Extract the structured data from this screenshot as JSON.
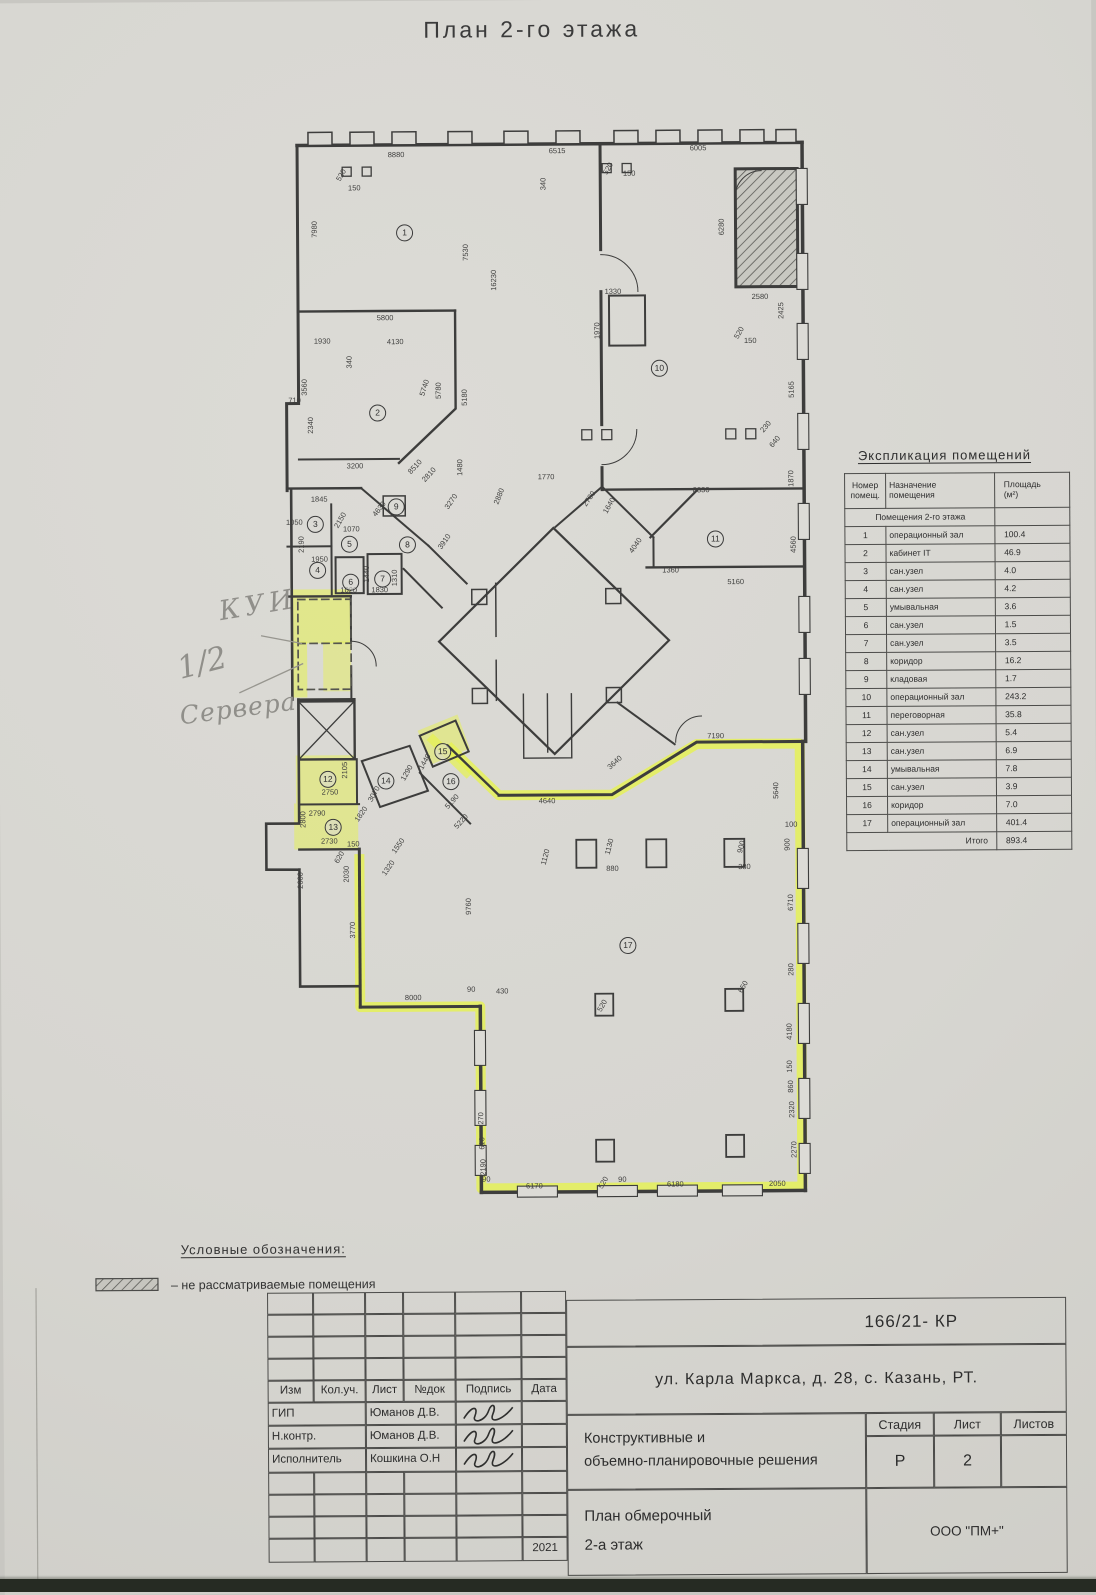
{
  "page": {
    "title": "План 2-го этажа"
  },
  "handwriting": {
    "note_kui": "КУИ",
    "note_half": "1/2",
    "note_servers": "Сервера"
  },
  "legend": {
    "heading": "Условные обозначения:",
    "item": "–  не рассматриваемые помещения"
  },
  "explication": {
    "title": "Экспликация помещений",
    "col1_line1": "Номер",
    "col1_line2": "помещ.",
    "col2_line1": "Назначение",
    "col2_line2": "помещения",
    "col3_line1": "Площадь",
    "col3_line2": "(м²)",
    "group": "Помещения 2-го этажа",
    "rows": [
      {
        "n": "1",
        "name": "операционный зал",
        "area": "100.4"
      },
      {
        "n": "2",
        "name": "кабинет IT",
        "area": "46.9"
      },
      {
        "n": "3",
        "name": "сан.узел",
        "area": "4.0"
      },
      {
        "n": "4",
        "name": "сан.узел",
        "area": "4.2"
      },
      {
        "n": "5",
        "name": "умывальная",
        "area": "3.6"
      },
      {
        "n": "6",
        "name": "сан.узел",
        "area": "1.5"
      },
      {
        "n": "7",
        "name": "сан.узел",
        "area": "3.5"
      },
      {
        "n": "8",
        "name": "коридор",
        "area": "16.2"
      },
      {
        "n": "9",
        "name": "кладовая",
        "area": "1.7"
      },
      {
        "n": "10",
        "name": "операционный зал",
        "area": "243.2"
      },
      {
        "n": "11",
        "name": "переговорная",
        "area": "35.8"
      },
      {
        "n": "12",
        "name": "сан.узел",
        "area": "5.4"
      },
      {
        "n": "13",
        "name": "сан.узел",
        "area": "6.9"
      },
      {
        "n": "14",
        "name": "умывальная",
        "area": "7.8"
      },
      {
        "n": "15",
        "name": "сан.узел",
        "area": "3.9"
      },
      {
        "n": "16",
        "name": "коридор",
        "area": "7.0"
      },
      {
        "n": "17",
        "name": "операционный зал",
        "area": "401.4"
      }
    ],
    "total_label": "Итого",
    "total": "893.4"
  },
  "plan": {
    "rooms": [
      {
        "n": "1",
        "x": 408,
        "y": 232
      },
      {
        "n": "2",
        "x": 380,
        "y": 412
      },
      {
        "n": "3",
        "x": 317,
        "y": 523
      },
      {
        "n": "4",
        "x": 319,
        "y": 569
      },
      {
        "n": "5",
        "x": 351,
        "y": 543
      },
      {
        "n": "6",
        "x": 352,
        "y": 581
      },
      {
        "n": "7",
        "x": 384,
        "y": 578
      },
      {
        "n": "8",
        "x": 409,
        "y": 544
      },
      {
        "n": "9",
        "x": 398,
        "y": 506
      },
      {
        "n": "10",
        "x": 662,
        "y": 369
      },
      {
        "n": "11",
        "x": 717,
        "y": 540
      },
      {
        "n": "12",
        "x": 328,
        "y": 778
      },
      {
        "n": "13",
        "x": 333,
        "y": 826
      },
      {
        "n": "14",
        "x": 386,
        "y": 780
      },
      {
        "n": "15",
        "x": 443,
        "y": 751
      },
      {
        "n": "16",
        "x": 451,
        "y": 781
      },
      {
        "n": "17",
        "x": 627,
        "y": 946
      }
    ],
    "dimensions": [
      {
        "t": "8880",
        "x": 400,
        "y": 154,
        "r": 0
      },
      {
        "t": "6515",
        "x": 561,
        "y": 151,
        "r": 0
      },
      {
        "t": "6005",
        "x": 702,
        "y": 149,
        "r": 0
      },
      {
        "t": "520",
        "x": 345,
        "y": 174,
        "r": -60
      },
      {
        "t": "150",
        "x": 358,
        "y": 187,
        "r": 0
      },
      {
        "t": "340",
        "x": 547,
        "y": 184,
        "r": -90
      },
      {
        "t": "520",
        "x": 612,
        "y": 169,
        "r": -60
      },
      {
        "t": "150",
        "x": 633,
        "y": 174,
        "r": 0
      },
      {
        "t": "7980",
        "x": 318,
        "y": 228,
        "r": -90
      },
      {
        "t": "7530",
        "x": 469,
        "y": 252,
        "r": -90
      },
      {
        "t": "16230",
        "x": 497,
        "y": 280,
        "r": -90
      },
      {
        "t": "2340",
        "x": 313,
        "y": 424,
        "r": -90
      },
      {
        "t": "3560",
        "x": 307,
        "y": 386,
        "r": -90
      },
      {
        "t": "710",
        "x": 297,
        "y": 399,
        "r": 0
      },
      {
        "t": "5800",
        "x": 388,
        "y": 317,
        "r": 0
      },
      {
        "t": "1930",
        "x": 325,
        "y": 340,
        "r": 0
      },
      {
        "t": "4130",
        "x": 398,
        "y": 341,
        "r": 0
      },
      {
        "t": "340",
        "x": 352,
        "y": 361,
        "r": -90
      },
      {
        "t": "5740",
        "x": 427,
        "y": 387,
        "r": -72
      },
      {
        "t": "5780",
        "x": 441,
        "y": 390,
        "r": -90
      },
      {
        "t": "5180",
        "x": 467,
        "y": 397,
        "r": -90
      },
      {
        "t": "1480",
        "x": 462,
        "y": 467,
        "r": -90
      },
      {
        "t": "8510",
        "x": 417,
        "y": 466,
        "r": -47
      },
      {
        "t": "2810",
        "x": 431,
        "y": 474,
        "r": -47
      },
      {
        "t": "3200",
        "x": 357,
        "y": 465,
        "r": 0
      },
      {
        "t": "1845",
        "x": 321,
        "y": 498,
        "r": 0
      },
      {
        "t": "1050",
        "x": 296,
        "y": 521,
        "r": 0
      },
      {
        "t": "2190",
        "x": 303,
        "y": 543,
        "r": -90
      },
      {
        "t": "1950",
        "x": 321,
        "y": 558,
        "r": 0
      },
      {
        "t": "2150",
        "x": 342,
        "y": 519,
        "r": -60
      },
      {
        "t": "4630",
        "x": 381,
        "y": 508,
        "r": -52
      },
      {
        "t": "1070",
        "x": 353,
        "y": 528,
        "r": 0
      },
      {
        "t": "1020",
        "x": 350,
        "y": 589,
        "r": 0
      },
      {
        "t": "1830",
        "x": 381,
        "y": 589,
        "r": 0
      },
      {
        "t": "1310",
        "x": 396,
        "y": 577,
        "r": -90
      },
      {
        "t": "1440",
        "x": 368,
        "y": 573,
        "r": -90
      },
      {
        "t": "3270",
        "x": 453,
        "y": 501,
        "r": -55
      },
      {
        "t": "3910",
        "x": 446,
        "y": 541,
        "r": -55
      },
      {
        "t": "2880",
        "x": 501,
        "y": 496,
        "r": -68
      },
      {
        "t": "2780",
        "x": 591,
        "y": 499,
        "r": -55
      },
      {
        "t": "1640",
        "x": 611,
        "y": 506,
        "r": -60
      },
      {
        "t": "1770",
        "x": 548,
        "y": 477,
        "r": 0
      },
      {
        "t": "1330",
        "x": 616,
        "y": 292,
        "r": 0
      },
      {
        "t": "1970",
        "x": 600,
        "y": 331,
        "r": -90
      },
      {
        "t": "6280",
        "x": 725,
        "y": 228,
        "r": -90
      },
      {
        "t": "2580",
        "x": 763,
        "y": 298,
        "r": 0
      },
      {
        "t": "2425",
        "x": 784,
        "y": 312,
        "r": -90
      },
      {
        "t": "520",
        "x": 742,
        "y": 334,
        "r": -60
      },
      {
        "t": "150",
        "x": 753,
        "y": 342,
        "r": 0
      },
      {
        "t": "5165",
        "x": 794,
        "y": 391,
        "r": -90
      },
      {
        "t": "230",
        "x": 768,
        "y": 428,
        "r": -50
      },
      {
        "t": "640",
        "x": 777,
        "y": 443,
        "r": -50
      },
      {
        "t": "1870",
        "x": 793,
        "y": 480,
        "r": -90
      },
      {
        "t": "8330",
        "x": 703,
        "y": 491,
        "r": 0
      },
      {
        "t": "4040",
        "x": 637,
        "y": 546,
        "r": -55
      },
      {
        "t": "1360",
        "x": 672,
        "y": 571,
        "r": 0
      },
      {
        "t": "5160",
        "x": 737,
        "y": 583,
        "r": 0
      },
      {
        "t": "4560",
        "x": 795,
        "y": 546,
        "r": -90
      },
      {
        "t": "7190",
        "x": 716,
        "y": 737,
        "r": 0
      },
      {
        "t": "5640",
        "x": 776,
        "y": 792,
        "r": -90
      },
      {
        "t": "3640",
        "x": 615,
        "y": 763,
        "r": -42
      },
      {
        "t": "4640",
        "x": 547,
        "y": 801,
        "r": 0
      },
      {
        "t": "100",
        "x": 791,
        "y": 826,
        "r": 0
      },
      {
        "t": "900",
        "x": 787,
        "y": 846,
        "r": -90
      },
      {
        "t": "1120",
        "x": 545,
        "y": 857,
        "r": -75
      },
      {
        "t": "1130",
        "x": 609,
        "y": 847,
        "r": -75
      },
      {
        "t": "880",
        "x": 612,
        "y": 869,
        "r": 0
      },
      {
        "t": "900",
        "x": 741,
        "y": 848,
        "r": -75
      },
      {
        "t": "380",
        "x": 744,
        "y": 868,
        "r": 0
      },
      {
        "t": "6710",
        "x": 790,
        "y": 904,
        "r": -90
      },
      {
        "t": "280",
        "x": 790,
        "y": 971,
        "r": -90
      },
      {
        "t": "650",
        "x": 742,
        "y": 988,
        "r": -60
      },
      {
        "t": "520",
        "x": 601,
        "y": 1006,
        "r": -60
      },
      {
        "t": "4180",
        "x": 788,
        "y": 1033,
        "r": -90
      },
      {
        "t": "150",
        "x": 788,
        "y": 1068,
        "r": -90
      },
      {
        "t": "860",
        "x": 789,
        "y": 1088,
        "r": -90
      },
      {
        "t": "2320",
        "x": 790,
        "y": 1111,
        "r": -90
      },
      {
        "t": "2270",
        "x": 792,
        "y": 1151,
        "r": -90
      },
      {
        "t": "2050",
        "x": 775,
        "y": 1185,
        "r": 0
      },
      {
        "t": "6170",
        "x": 532,
        "y": 1186,
        "r": 0
      },
      {
        "t": "520",
        "x": 601,
        "y": 1183,
        "r": -60
      },
      {
        "t": "90",
        "x": 620,
        "y": 1180,
        "r": 0
      },
      {
        "t": "6180",
        "x": 673,
        "y": 1185,
        "r": 0
      },
      {
        "t": "90",
        "x": 484,
        "y": 1179,
        "r": 0
      },
      {
        "t": "2190",
        "x": 481,
        "y": 1167,
        "r": -90
      },
      {
        "t": "610",
        "x": 480,
        "y": 1143,
        "r": -90
      },
      {
        "t": "270",
        "x": 479,
        "y": 1118,
        "r": -90
      },
      {
        "t": "9760",
        "x": 468,
        "y": 906,
        "r": -90
      },
      {
        "t": "90",
        "x": 470,
        "y": 989,
        "r": 0
      },
      {
        "t": "430",
        "x": 501,
        "y": 991,
        "r": 0
      },
      {
        "t": "8000",
        "x": 412,
        "y": 997,
        "r": 0
      },
      {
        "t": "3770",
        "x": 352,
        "y": 929,
        "r": -90
      },
      {
        "t": "2030",
        "x": 346,
        "y": 873,
        "r": -90
      },
      {
        "t": "620",
        "x": 339,
        "y": 856,
        "r": -60
      },
      {
        "t": "150",
        "x": 353,
        "y": 843,
        "r": 0
      },
      {
        "t": "2730",
        "x": 329,
        "y": 840,
        "r": 0
      },
      {
        "t": "2750",
        "x": 330,
        "y": 791,
        "r": 0
      },
      {
        "t": "2790",
        "x": 317,
        "y": 812,
        "r": 0
      },
      {
        "t": "2800",
        "x": 303,
        "y": 818,
        "r": -90
      },
      {
        "t": "2600",
        "x": 300,
        "y": 879,
        "r": -90
      },
      {
        "t": "2105",
        "x": 345,
        "y": 769,
        "r": -90
      },
      {
        "t": "3070",
        "x": 374,
        "y": 793,
        "r": -60
      },
      {
        "t": "1820",
        "x": 361,
        "y": 813,
        "r": -55
      },
      {
        "t": "1550",
        "x": 398,
        "y": 845,
        "r": -55
      },
      {
        "t": "1320",
        "x": 388,
        "y": 867,
        "r": -55
      },
      {
        "t": "1440",
        "x": 425,
        "y": 761,
        "r": -60
      },
      {
        "t": "1290",
        "x": 407,
        "y": 772,
        "r": -60
      },
      {
        "t": "5190",
        "x": 452,
        "y": 801,
        "r": -48
      },
      {
        "t": "5220",
        "x": 461,
        "y": 821,
        "r": -48
      }
    ]
  },
  "titleblock": {
    "doc_code": "166/21- КР",
    "address": "ул. Карла Маркса, д. 28, с. Казань, РТ.",
    "cols": [
      "Изм",
      "Кол.уч.",
      "Лист",
      "№док",
      "Подпись",
      "Дата"
    ],
    "rows": [
      {
        "role": "ГИП",
        "name": "Юманов Д.В."
      },
      {
        "role": "Н.контр.",
        "name": "Юманов Д.В."
      },
      {
        "role": "Исполнитель",
        "name": "Кошкина О.Н"
      }
    ],
    "section_line1": "Конструктивные и",
    "section_line2": "объемно-планировочные решения",
    "stage_label": "Стадия",
    "sheet_label": "Лист",
    "sheets_label": "Листов",
    "stage": "Р",
    "sheet": "2",
    "sheets": "",
    "drawing_line1": "План обмерочный",
    "drawing_line2": "2-а этаж",
    "company": "ООО \"ПМ+\"",
    "year": "2021"
  },
  "colors": {
    "highlighter": "#e6f25a",
    "ink": "#3f3f3e",
    "pencil": "#908f8a"
  }
}
